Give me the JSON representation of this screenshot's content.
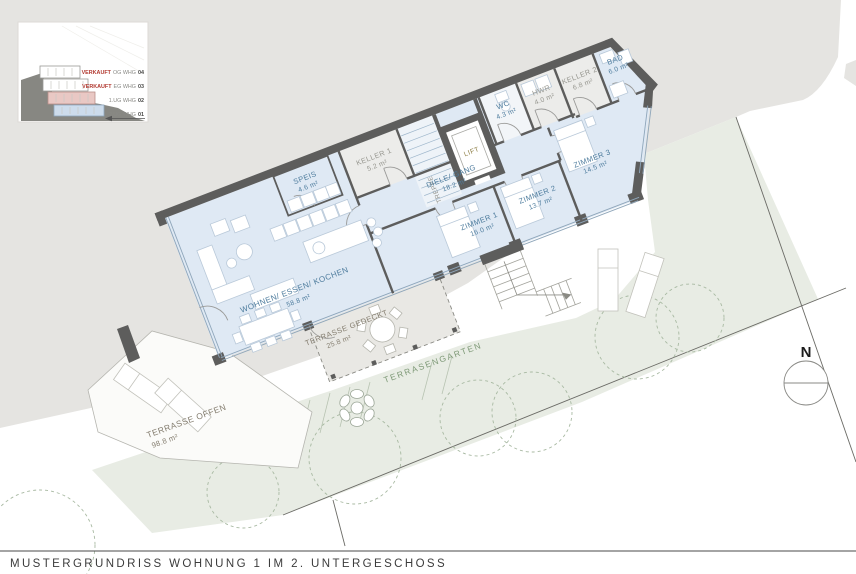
{
  "title": "MUSTERGRUNDRISS WOHNUNG 1 IM 2. UNTERGESCHOSS",
  "north_label": "N",
  "inset": {
    "rows": [
      {
        "status": "VERKAUFT",
        "unit": "OG WHG",
        "num": "04"
      },
      {
        "status": "VERKAUFT",
        "unit": "EG WHG",
        "num": "03"
      },
      {
        "status": "",
        "unit": "1.UG WHG",
        "num": "02"
      },
      {
        "status": "",
        "unit": "2.UG WHG",
        "num": "01"
      }
    ]
  },
  "rooms": {
    "wohnen": {
      "name": "WOHNEN/ ESSEN/ KOCHEN",
      "area": "58.8 m²"
    },
    "speis": {
      "name": "SPEIS",
      "area": "4.6 m²"
    },
    "keller1": {
      "name": "KELLER 1",
      "area": "5.2 m²"
    },
    "treppe": {
      "name": "TREPPE"
    },
    "lift": {
      "name": "LIFT"
    },
    "wc": {
      "name": "WC",
      "area": "4.3 m²"
    },
    "hwr": {
      "name": "HWR",
      "area": "4.0 m²"
    },
    "keller2": {
      "name": "KELLER 2",
      "area": "6.8 m²"
    },
    "bad": {
      "name": "BAD",
      "area": "6.0 m²"
    },
    "diele": {
      "name": "DIELE/ GANG",
      "area": "18.2 m²"
    },
    "zimmer1": {
      "name": "ZIMMER 1",
      "area": "16.0 m²"
    },
    "zimmer2": {
      "name": "ZIMMER 2",
      "area": "13.7 m²"
    },
    "zimmer3": {
      "name": "ZIMMER 3",
      "area": "14.5 m²"
    }
  },
  "outdoor": {
    "terrasse_gedeckt": {
      "name": "TERRASSE GEDECKT",
      "area": "25.8 m²"
    },
    "terrasse_offen": {
      "name": "TERRASSE OFFEN",
      "area": "98.8 m²"
    },
    "terrassengarten": {
      "name": "TERRASENGARTEN"
    }
  },
  "colors": {
    "hill_gray": "#e5e4e1",
    "garden_green": "#e8ece4",
    "floor_blue": "#dfe9f4",
    "wall_dark": "#5d5d5c",
    "label_blue": "#4f7d9e",
    "label_gray": "#96968f",
    "verkauft_red": "#b23a31",
    "garden_label_green": "#7f9a78",
    "lift_olive": "#8f8048",
    "sold_pink_floor": "#e9c8c4",
    "current_blue_floor": "#cddcec"
  }
}
